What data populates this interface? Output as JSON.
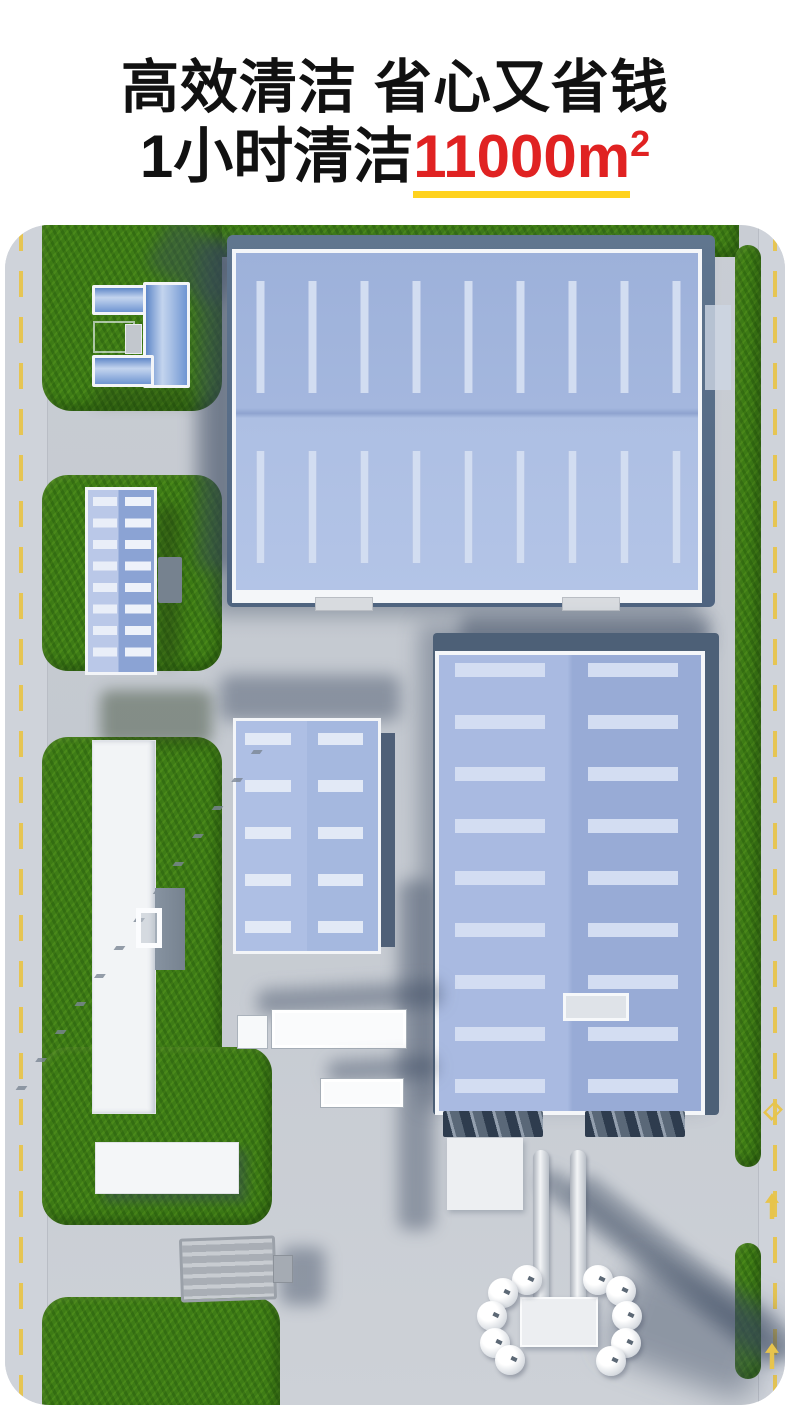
{
  "header": {
    "line1": "高效清洁 省心又省钱",
    "line2": {
      "prefix": "1小时清洁",
      "highlight": "11000m",
      "superscript": "2"
    },
    "text_color": "#111111",
    "highlight_color": "#e02222",
    "underline_color": "#ffd21e"
  },
  "scene": {
    "type": "aerial-3d-render",
    "subject": "industrial-park-top-view",
    "palette": {
      "grass": "#3e7c16",
      "pavement": "#c6cad1",
      "road": "#cfd3da",
      "road_marking_yellow": "#e7c44c",
      "roof_blue": "#a7b9e0",
      "skylight": "#d3ddf2",
      "dark_wall": "#4d6077",
      "white_building": "#f3f5f7"
    },
    "elements": [
      "u-shaped-office-building",
      "large-blue-warehouse-top",
      "striped-blue-workshop-left",
      "medium-blue-workshop-center",
      "long-white-building",
      "white-flat-building",
      "tall-blue-warehouse-bottom",
      "twin-chimneys",
      "silo-tank-cluster",
      "trucks",
      "gray-flatbed-machine",
      "perimeter-roads-with-yellow-dashes"
    ]
  }
}
